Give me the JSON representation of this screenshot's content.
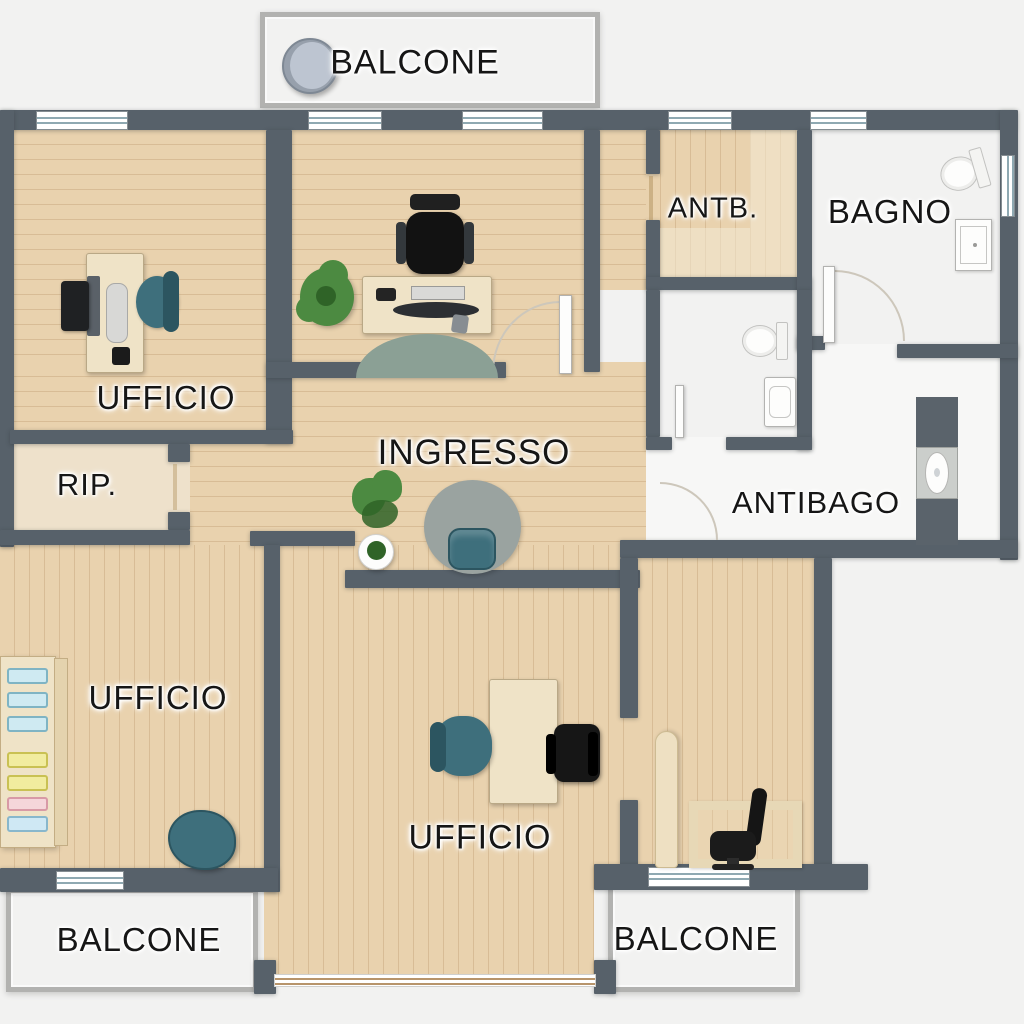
{
  "plan": {
    "type": "architectural floor plan (top view)",
    "labels": {
      "balcone_top": "BALCONE",
      "ufficio_top_left": "UFFICIO",
      "antb": "ANTB.",
      "bagno": "BAGNO",
      "rip": "RIP.",
      "ingresso": "INGRESSO",
      "antibago": "ANTIBAGO",
      "ufficio_mid_left": "UFFICIO",
      "ufficio_bottom": "UFFICIO",
      "balcone_bottom_left": "BALCONE",
      "balcone_bottom_right": "BALCONE"
    },
    "furniture_icons": [
      "desk",
      "computer-monitor",
      "tablet",
      "office-chair",
      "executive-chair",
      "plant",
      "half-round-rug",
      "round-rug",
      "armchair",
      "toilet",
      "sink",
      "cabinet",
      "storage-shelf",
      "storage-bins",
      "door-swing",
      "balcony-chair"
    ]
  },
  "colors": {
    "bg": "#f2f2f1",
    "wall": "#57616a",
    "wood": "#e9d2ae",
    "woodLine": "rgba(155,112,62,0.22)",
    "ripFloor": "#eee1cb",
    "bagnoTile": "#a8cfda",
    "bagnoLine": "rgba(64,112,124,0.35)",
    "wcTile": "#ececea",
    "wcLine": "rgba(160,160,158,0.55)",
    "antibagoFloor": "#f7f7f6",
    "balcony": "#e3e3e1",
    "balconyFrame": "#b2b2b0",
    "windowStripe": "#8fa9b2",
    "teal": "#3e6f7c",
    "tealDark": "#2c5560",
    "green": "#4c8a41",
    "greenDark": "#2f6327",
    "deskWood": "#efe3c7",
    "rugGray": "#9aa3a0",
    "rugGreenGray": "#8ba095",
    "doorArc": "#cdc7bb",
    "labelColor": "#161616"
  }
}
